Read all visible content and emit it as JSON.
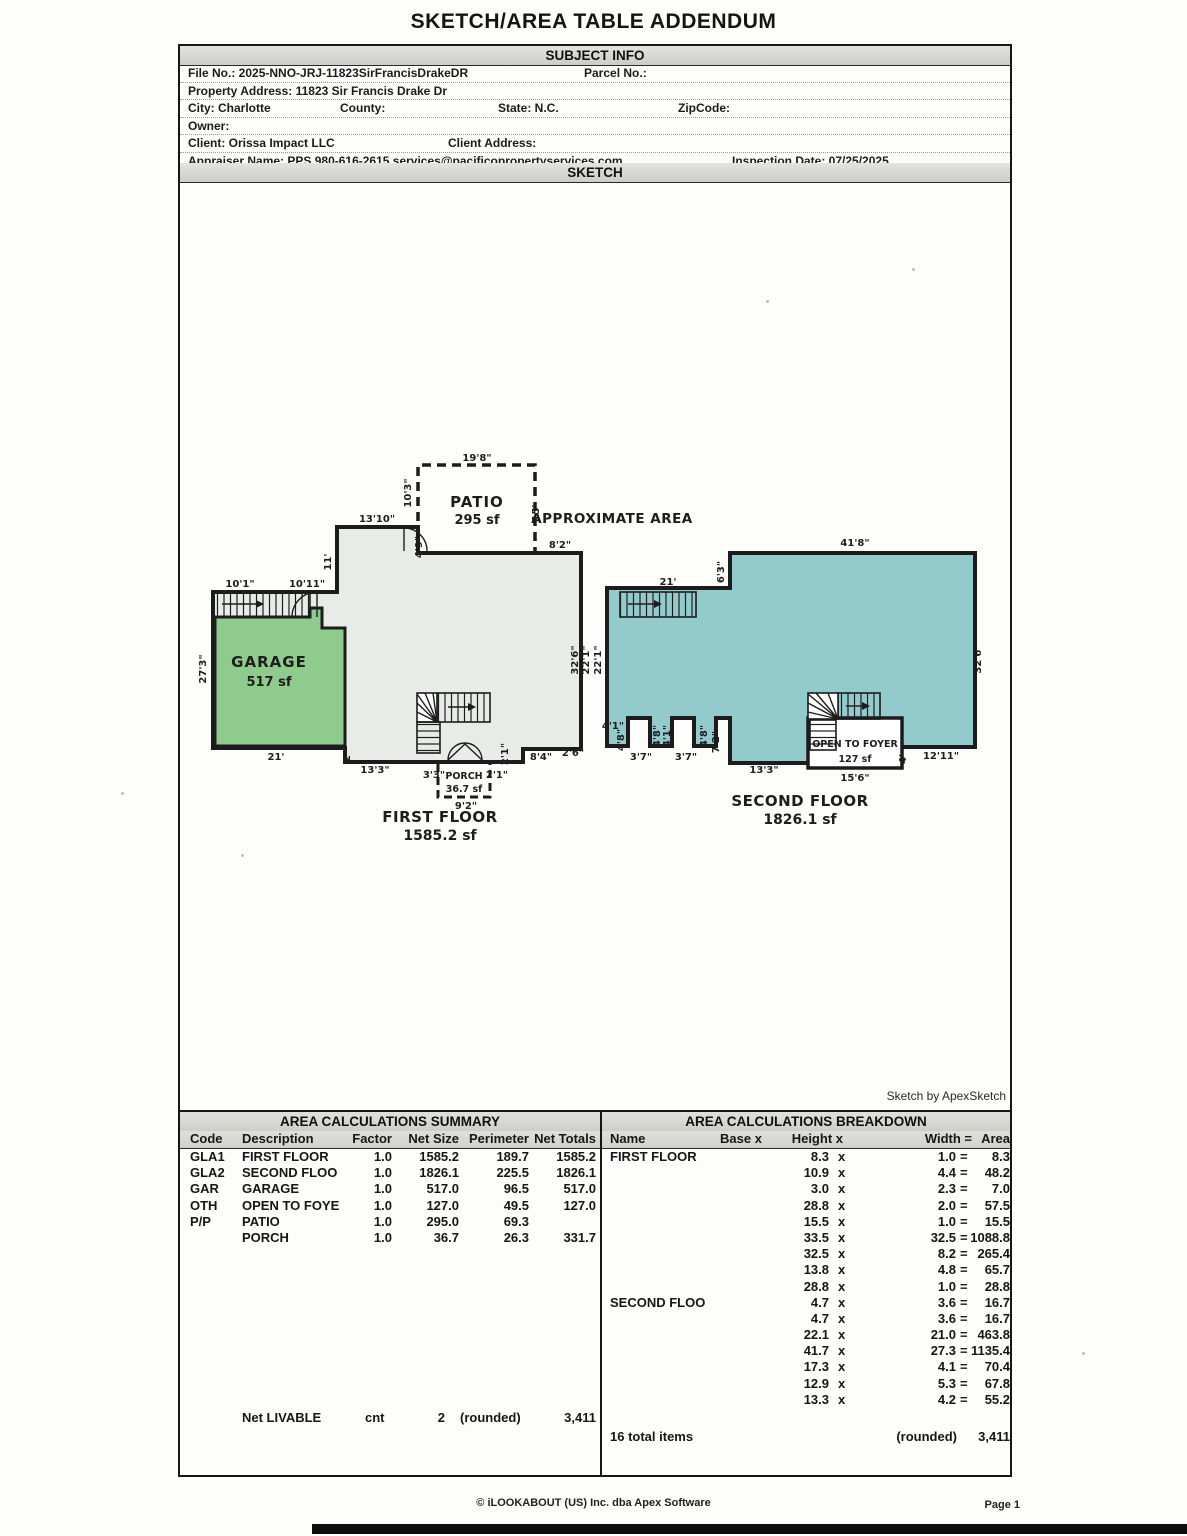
{
  "page": {
    "title": "SKETCH/AREA TABLE ADDENDUM",
    "footer_copyright": "© iLOOKABOUT (US) Inc. dba Apex Software",
    "footer_page": "Page 1"
  },
  "subject_info": {
    "section_title": "SUBJECT INFO",
    "rows": [
      {
        "fields": [
          {
            "x": 8,
            "text": "File No.: 2025-NNO-JRJ-11823SirFrancisDrakeDR"
          },
          {
            "x": 404,
            "text": "Parcel No.:"
          }
        ]
      },
      {
        "fields": [
          {
            "x": 8,
            "text": "Property Address: 11823 Sir Francis Drake Dr"
          }
        ]
      },
      {
        "fields": [
          {
            "x": 8,
            "text": "City: Charlotte"
          },
          {
            "x": 160,
            "text": "County:"
          },
          {
            "x": 318,
            "text": "State: N.C."
          },
          {
            "x": 498,
            "text": "ZipCode:"
          }
        ]
      },
      {
        "fields": [
          {
            "x": 8,
            "text": "Owner:"
          }
        ]
      },
      {
        "fields": [
          {
            "x": 8,
            "text": "Client: Orissa Impact LLC"
          },
          {
            "x": 268,
            "text": "Client Address:"
          }
        ]
      },
      {
        "fields": [
          {
            "x": 8,
            "text": "Appraiser Name: PPS 980-616-2615 services@pacificopropertyservices.com"
          },
          {
            "x": 552,
            "text": "Inspection Date: 07/25/2025"
          }
        ]
      }
    ]
  },
  "sketch": {
    "section_title": "SKETCH",
    "credit": "Sketch by ApexSketch",
    "colors": {
      "first_floor": "#e9ebe8",
      "garage": "#8fcb8c",
      "second_floor": "#93cbcd",
      "wall": "#1c1c1c"
    },
    "labels": [
      {
        "x": 477,
        "y": 461,
        "t": "19'8\""
      },
      {
        "x": 411,
        "y": 493,
        "t": "10'3\"",
        "r": 1
      },
      {
        "x": 477,
        "y": 507,
        "t": "PATIO",
        "c": "room"
      },
      {
        "x": 477,
        "y": 524,
        "t": "295 sf",
        "c": "room2"
      },
      {
        "x": 539,
        "y": 513,
        "t": "15'",
        "r": 1
      },
      {
        "x": 612,
        "y": 523,
        "t": "APPROXIMATE AREA",
        "c": "approx"
      },
      {
        "x": 377,
        "y": 522,
        "t": "13'10\""
      },
      {
        "x": 422,
        "y": 547,
        "t": "4'9\"",
        "r": 1
      },
      {
        "x": 560,
        "y": 548,
        "t": "8'2\""
      },
      {
        "x": 331,
        "y": 562,
        "t": "11'",
        "r": 1
      },
      {
        "x": 240,
        "y": 587,
        "t": "10'1\""
      },
      {
        "x": 307,
        "y": 587,
        "t": "10'11\""
      },
      {
        "x": 206,
        "y": 669,
        "t": "27'3\"",
        "r": 1
      },
      {
        "x": 269,
        "y": 667,
        "t": "GARAGE",
        "c": "room"
      },
      {
        "x": 269,
        "y": 686,
        "t": "517 sf",
        "c": "room2"
      },
      {
        "x": 578,
        "y": 660,
        "t": "32'6\"",
        "r": 1
      },
      {
        "x": 589,
        "y": 660,
        "t": "22'1\"",
        "r": 1
      },
      {
        "x": 276,
        "y": 760,
        "t": "21'"
      },
      {
        "x": 350,
        "y": 757,
        "t": "2'",
        "r": 1
      },
      {
        "x": 375,
        "y": 773,
        "t": "13'3\""
      },
      {
        "x": 434,
        "y": 778,
        "t": "3'3\""
      },
      {
        "x": 464,
        "y": 779,
        "t": "PORCH",
        "c": "small"
      },
      {
        "x": 464,
        "y": 792,
        "t": "36.7 sf",
        "c": "small"
      },
      {
        "x": 466,
        "y": 809,
        "t": "9'2\""
      },
      {
        "x": 497,
        "y": 778,
        "t": "2'1\""
      },
      {
        "x": 508,
        "y": 754,
        "t": "2'1\"",
        "r": 1
      },
      {
        "x": 541,
        "y": 760,
        "t": "8'4\""
      },
      {
        "x": 573,
        "y": 756,
        "t": "2'6\""
      },
      {
        "x": 440,
        "y": 822,
        "t": "FIRST FLOOR",
        "c": "floor"
      },
      {
        "x": 440,
        "y": 840,
        "t": "1585.2 sf",
        "c": "floor2"
      },
      {
        "x": 855,
        "y": 546,
        "t": "41'8\""
      },
      {
        "x": 724,
        "y": 572,
        "t": "6'3\"",
        "r": 1
      },
      {
        "x": 668,
        "y": 585,
        "t": "21'"
      },
      {
        "x": 601,
        "y": 660,
        "t": "22'1\"",
        "r": 1
      },
      {
        "x": 981,
        "y": 659,
        "t": "32'6\"",
        "r": 1
      },
      {
        "x": 613,
        "y": 729,
        "t": "4'1\""
      },
      {
        "x": 624,
        "y": 740,
        "t": "4'8\"",
        "r": 1
      },
      {
        "x": 641,
        "y": 760,
        "t": "3'7\""
      },
      {
        "x": 660,
        "y": 736,
        "t": "4'8\"",
        "r": 1
      },
      {
        "x": 670,
        "y": 736,
        "t": "4'1\"",
        "r": 1
      },
      {
        "x": 686,
        "y": 760,
        "t": "3'7\""
      },
      {
        "x": 707,
        "y": 736,
        "t": "4'8\"",
        "r": 1
      },
      {
        "x": 719,
        "y": 742,
        "t": "7'2\"",
        "r": 1
      },
      {
        "x": 764,
        "y": 773,
        "t": "13'3\""
      },
      {
        "x": 855,
        "y": 747,
        "t": "OPEN TO FOYER",
        "c": "small"
      },
      {
        "x": 855,
        "y": 762,
        "t": "127 sf",
        "c": "small"
      },
      {
        "x": 855,
        "y": 781,
        "t": "15'6\""
      },
      {
        "x": 906,
        "y": 759,
        "t": "4'",
        "r": 1
      },
      {
        "x": 941,
        "y": 759,
        "t": "12'11\""
      },
      {
        "x": 800,
        "y": 806,
        "t": "SECOND FLOOR",
        "c": "floor"
      },
      {
        "x": 800,
        "y": 824,
        "t": "1826.1 sf",
        "c": "floor2"
      }
    ]
  },
  "summary_table": {
    "title": "AREA CALCULATIONS SUMMARY",
    "headers": [
      "Code",
      "Description",
      "Factor",
      "Net Size",
      "Perimeter",
      "Net Totals"
    ],
    "rows": [
      {
        "code": "GLA1",
        "description": "FIRST FLOOR",
        "factor": "1.0",
        "net_size": "1585.2",
        "perimeter": "189.7",
        "net_totals": "1585.2"
      },
      {
        "code": "GLA2",
        "description": "SECOND FLOO",
        "factor": "1.0",
        "net_size": "1826.1",
        "perimeter": "225.5",
        "net_totals": "1826.1"
      },
      {
        "code": "GAR",
        "description": "GARAGE",
        "factor": "1.0",
        "net_size": "517.0",
        "perimeter": "96.5",
        "net_totals": "517.0"
      },
      {
        "code": "OTH",
        "description": "OPEN TO FOYE",
        "factor": "1.0",
        "net_size": "127.0",
        "perimeter": "49.5",
        "net_totals": "127.0"
      },
      {
        "code": "P/P",
        "description": "PATIO",
        "factor": "1.0",
        "net_size": "295.0",
        "perimeter": "69.3",
        "net_totals": ""
      },
      {
        "code": "",
        "description": "PORCH",
        "factor": "1.0",
        "net_size": "36.7",
        "perimeter": "26.3",
        "net_totals": "331.7"
      }
    ],
    "footer": {
      "label": "Net LIVABLE",
      "cnt": "cnt",
      "count": "2",
      "rounded": "(rounded)",
      "total": "3,411"
    }
  },
  "breakdown_table": {
    "title": "AREA CALCULATIONS BREAKDOWN",
    "headers": [
      "Name",
      "Base x",
      "Height x",
      "Width =",
      "Area"
    ],
    "rows": [
      {
        "name": "FIRST FLOOR",
        "height": "8.3",
        "width": "1.0",
        "area": "8.3"
      },
      {
        "name": "",
        "height": "10.9",
        "width": "4.4",
        "area": "48.2"
      },
      {
        "name": "",
        "height": "3.0",
        "width": "2.3",
        "area": "7.0"
      },
      {
        "name": "",
        "height": "28.8",
        "width": "2.0",
        "area": "57.5"
      },
      {
        "name": "",
        "height": "15.5",
        "width": "1.0",
        "area": "15.5"
      },
      {
        "name": "",
        "height": "33.5",
        "width": "32.5",
        "area": "1088.8"
      },
      {
        "name": "",
        "height": "32.5",
        "width": "8.2",
        "area": "265.4"
      },
      {
        "name": "",
        "height": "13.8",
        "width": "4.8",
        "area": "65.7"
      },
      {
        "name": "",
        "height": "28.8",
        "width": "1.0",
        "area": "28.8"
      },
      {
        "name": "SECOND FLOO",
        "height": "4.7",
        "width": "3.6",
        "area": "16.7"
      },
      {
        "name": "",
        "height": "4.7",
        "width": "3.6",
        "area": "16.7"
      },
      {
        "name": "",
        "height": "22.1",
        "width": "21.0",
        "area": "463.8"
      },
      {
        "name": "",
        "height": "41.7",
        "width": "27.3",
        "area": "1135.4"
      },
      {
        "name": "",
        "height": "17.3",
        "width": "4.1",
        "area": "70.4"
      },
      {
        "name": "",
        "height": "12.9",
        "width": "5.3",
        "area": "67.8"
      },
      {
        "name": "",
        "height": "13.3",
        "width": "4.2",
        "area": "55.2"
      }
    ],
    "footer": {
      "items": "16 total items",
      "rounded": "(rounded)",
      "total": "3,411"
    }
  },
  "ops": {
    "times": "x",
    "equals": "="
  }
}
